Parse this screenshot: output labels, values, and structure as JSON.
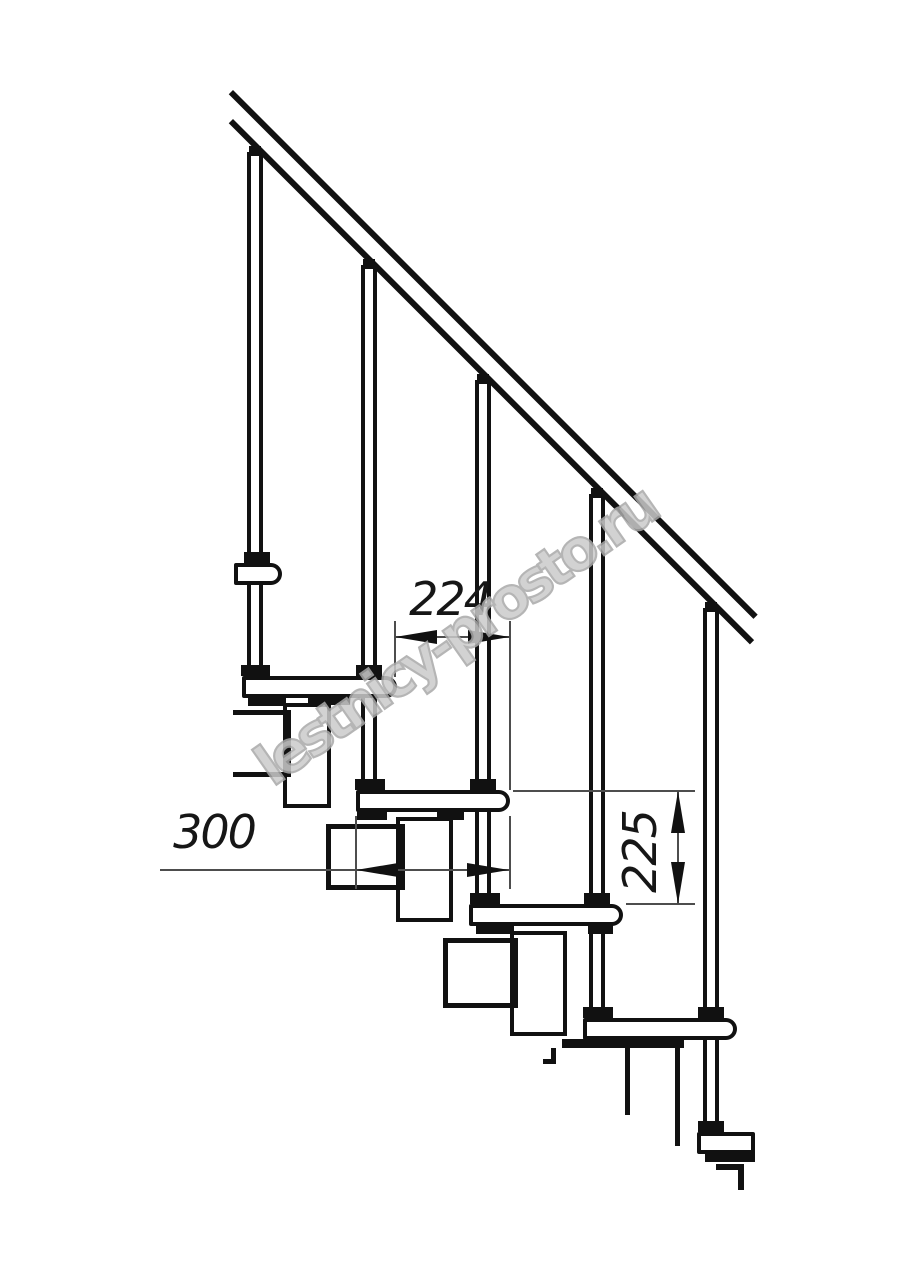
{
  "drawing": {
    "description": "Side-view technical drawing of a modular staircase fragment with handrail, balusters, treads and support modules",
    "ink_color": "#111111",
    "thin_line_color": "#4d4d4d",
    "watermark_color": "#a9a9a9",
    "background": "#ffffff"
  },
  "watermark": {
    "text": "lestnicy-prosto.ru"
  },
  "dimensions": [
    {
      "id": "dim-224",
      "label": "224",
      "meaning": "step-run",
      "box": [
        404,
        576,
        92,
        46
      ],
      "rotate": 0
    },
    {
      "id": "dim-300",
      "label": "300",
      "meaning": "tread-depth",
      "box": [
        168,
        809,
        92,
        46
      ],
      "rotate": 0
    },
    {
      "id": "dim-225",
      "label": "225",
      "meaning": "step-rise",
      "box": [
        594,
        829,
        92,
        46
      ],
      "rotate": -90
    }
  ],
  "geometry": {
    "rails": [
      {
        "name": "handrail-upper-line",
        "x": 233,
        "y": 90,
        "len": 742
      },
      {
        "name": "handrail-lower-line",
        "x": 233,
        "y": 119,
        "len": 737
      }
    ],
    "balusters": [
      {
        "x": 247,
        "y": 152,
        "h": 524
      },
      {
        "x": 361,
        "y": 265,
        "h": 525
      },
      {
        "x": 475,
        "y": 380,
        "h": 524
      },
      {
        "x": 589,
        "y": 494,
        "h": 524
      },
      {
        "x": 703,
        "y": 608,
        "h": 524
      }
    ],
    "plates": [
      [
        283,
        703,
        48,
        105
      ],
      [
        396,
        817,
        57,
        105
      ],
      [
        510,
        931,
        57,
        105
      ]
    ],
    "boxes": [
      {
        "rect": [
          233,
          710,
          58,
          67
        ],
        "open_left": true
      },
      {
        "rect": [
          326,
          824,
          79,
          66
        ],
        "open_left": false
      },
      {
        "rect": [
          443,
          938,
          75,
          70
        ],
        "open_left": false
      }
    ],
    "treads": [
      {
        "rect": [
          234,
          563,
          48
        ],
        "nose": "round"
      },
      {
        "rect": [
          242,
          676,
          155
        ],
        "nose": "round"
      },
      {
        "rect": [
          356,
          790,
          154
        ],
        "nose": "round"
      },
      {
        "rect": [
          469,
          904,
          154
        ],
        "nose": "round"
      },
      {
        "rect": [
          583,
          1018,
          154
        ],
        "nose": "round"
      },
      {
        "rect": [
          697,
          1132,
          58
        ],
        "nose": "square"
      }
    ],
    "caps": [
      [
        249,
        146,
        12,
        10
      ],
      [
        363,
        259,
        12,
        10
      ],
      [
        477,
        374,
        12,
        10
      ],
      [
        591,
        488,
        12,
        10
      ],
      [
        705,
        602,
        12,
        10
      ]
    ],
    "mounts": [
      [
        244,
        552,
        26,
        11
      ],
      [
        241,
        665,
        29,
        11
      ],
      [
        356,
        665,
        26,
        11
      ],
      [
        355,
        779,
        30,
        11
      ],
      [
        470,
        779,
        26,
        11
      ],
      [
        470,
        893,
        30,
        11
      ],
      [
        584,
        893,
        26,
        11
      ],
      [
        583,
        1007,
        30,
        11
      ],
      [
        698,
        1007,
        26,
        11
      ],
      [
        698,
        1121,
        26,
        11
      ]
    ],
    "tabs": [
      [
        248,
        697,
        38,
        9
      ],
      [
        308,
        696,
        42,
        9
      ],
      [
        357,
        811,
        30,
        9
      ],
      [
        437,
        811,
        27,
        9
      ],
      [
        476,
        925,
        38,
        9
      ],
      [
        588,
        925,
        25,
        9
      ],
      [
        562,
        1039,
        122,
        9
      ],
      [
        705,
        1152,
        50,
        10
      ]
    ],
    "cut_lines": [
      [
        551,
        1048,
        5,
        16
      ],
      [
        543,
        1059,
        10,
        5
      ],
      [
        625,
        1048,
        5,
        67
      ],
      [
        675,
        1043,
        5,
        103
      ],
      [
        716,
        1164,
        24,
        6
      ],
      [
        738,
        1164,
        6,
        26
      ]
    ],
    "thin_lines": [
      {
        "name": "dim-line-224",
        "rect": [
          395,
          636,
          115,
          2
        ]
      },
      {
        "name": "extension-line",
        "rect": [
          394,
          621,
          2,
          56
        ]
      },
      {
        "name": "extension-line",
        "rect": [
          509,
          621,
          2,
          169
        ]
      },
      {
        "name": "dim-line-300",
        "rect": [
          160,
          869,
          350,
          2
        ]
      },
      {
        "name": "extension-line",
        "rect": [
          355,
          816,
          2,
          73
        ]
      },
      {
        "name": "extension-line",
        "rect": [
          509,
          816,
          2,
          73
        ]
      },
      {
        "name": "dim-line-225",
        "rect": [
          677,
          791,
          2,
          113
        ]
      },
      {
        "name": "extension-line",
        "rect": [
          513,
          790,
          182,
          2
        ]
      },
      {
        "name": "extension-line",
        "rect": [
          626,
          903,
          69,
          2
        ]
      }
    ],
    "arrows": [
      {
        "tip": [
          395,
          637
        ],
        "dir": "left"
      },
      {
        "tip": [
          510,
          637
        ],
        "dir": "right"
      },
      {
        "tip": [
          356,
          870
        ],
        "dir": "left"
      },
      {
        "tip": [
          509,
          870
        ],
        "dir": "right"
      },
      {
        "tip": [
          678,
          791
        ],
        "dir": "up"
      },
      {
        "tip": [
          678,
          904
        ],
        "dir": "down"
      }
    ],
    "arrow_size": {
      "length": 42,
      "half_width": 7
    }
  }
}
